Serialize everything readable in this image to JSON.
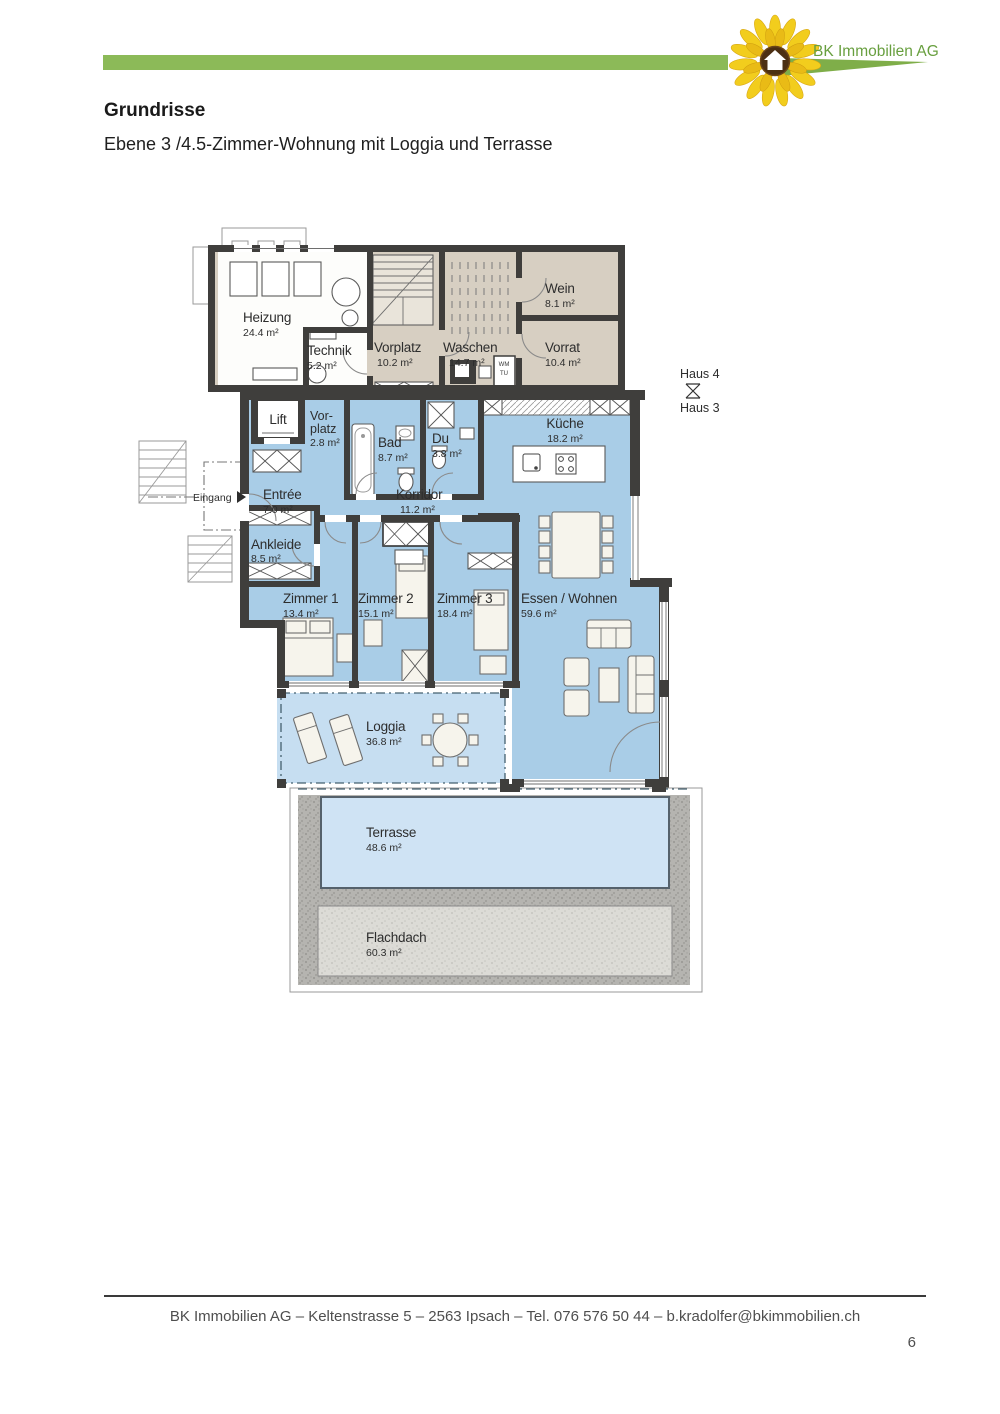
{
  "header": {
    "company": "BK Immobilien AG"
  },
  "document": {
    "title": "Grundrisse",
    "subtitle": "Ebene 3 /4.5-Zimmer-Wohnung mit Loggia und Terrasse"
  },
  "plan": {
    "rooms": {
      "heizung": {
        "name": "Heizung",
        "area": "24.4 m²"
      },
      "technik": {
        "name": "Technik",
        "area": "5.2 m²"
      },
      "vorplatz_og": {
        "name": "Vorplatz",
        "area": "10.2 m²"
      },
      "waschen": {
        "name": "Waschen",
        "area": "14.7 m²"
      },
      "wein": {
        "name": "Wein",
        "area": "8.1 m²"
      },
      "vorrat": {
        "name": "Vorrat",
        "area": "10.4 m²"
      },
      "lift": {
        "name": "Lift"
      },
      "vorplatz_wohnung": {
        "line1": "Vor-",
        "line2": "platz",
        "area": "2.8 m²"
      },
      "bad": {
        "name": "Bad",
        "area": "8.7 m²"
      },
      "du": {
        "name": "Du",
        "area": "3.8 m²"
      },
      "kueche": {
        "name": "Küche",
        "area": "18.2 m²"
      },
      "entree": {
        "name": "Entrée",
        "area": "7.0 m²"
      },
      "korridor": {
        "name": "Korridor",
        "area": "11.2 m²"
      },
      "ankleide": {
        "name": "Ankleide",
        "area": "8.5 m²"
      },
      "zimmer1": {
        "name": "Zimmer 1",
        "area": "13.4 m²"
      },
      "zimmer2": {
        "name": "Zimmer 2",
        "area": "15.1 m²"
      },
      "zimmer3": {
        "name": "Zimmer 3",
        "area": "18.4 m²"
      },
      "essen_wohnen": {
        "name": "Essen / Wohnen",
        "area": "59.6 m²"
      },
      "loggia": {
        "name": "Loggia",
        "area": "36.8 m²"
      },
      "terrasse": {
        "name": "Terrasse",
        "area": "48.6 m²"
      },
      "flachdach": {
        "name": "Flachdach",
        "area": "60.3 m²"
      }
    },
    "markers": {
      "haus_oben": "Haus 4",
      "haus_unten": "Haus 3",
      "eingang": "Eingang",
      "wm": "WM",
      "tu": "TU"
    },
    "colors": {
      "wall": "#3f3e3c",
      "apartment_blue": "#a9cde7",
      "loggia_blue": "#c6def1",
      "terrasse_blue": "#cfe3f4",
      "common_beige": "#d7cfc2",
      "accent_green": "#8cba58"
    }
  },
  "footer": {
    "contact": "BK Immobilien AG – Keltenstrasse 5 – 2563 Ipsach – Tel. 076 576 50 44 – b.kradolfer@bkimmobilien.ch",
    "page_number": "6"
  }
}
